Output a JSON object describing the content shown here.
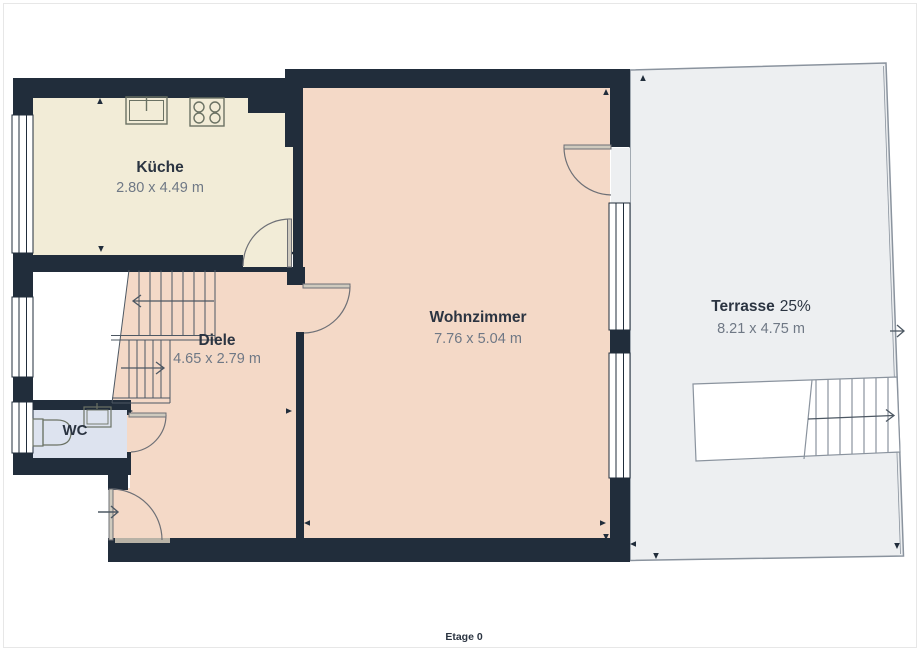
{
  "plan": {
    "floor_label": "Etage 0",
    "rooms": {
      "kueche": {
        "name": "Küche",
        "dims": "2.80 x 4.49 m"
      },
      "diele": {
        "name": "Diele",
        "dims": "4.65 x 2.79 m"
      },
      "wohnzimmer": {
        "name": "Wohnzimmer",
        "dims": "7.76 x 5.04 m"
      },
      "wc": {
        "name": "WC"
      },
      "terrasse": {
        "name": "Terrasse",
        "share": "25%",
        "dims": "8.21 x 4.75 m"
      }
    },
    "colors": {
      "wall": "#212d3b",
      "kueche_floor": "#f2ecd7",
      "living_floor": "#f4d9c7",
      "wc_floor": "#dde3ef",
      "terrace_floor": "#edeff1",
      "terrace_border": "#8a939e",
      "room_name_text": "#2b3441",
      "dim_text": "#6f7885",
      "stair_line": "#4d5863",
      "door_line": "#6e7076",
      "leaf_fill": "#cfcabe",
      "fixture_line": "#6b7264",
      "threshold": "#b8b2a6",
      "frame": "#e7e7e7"
    }
  }
}
